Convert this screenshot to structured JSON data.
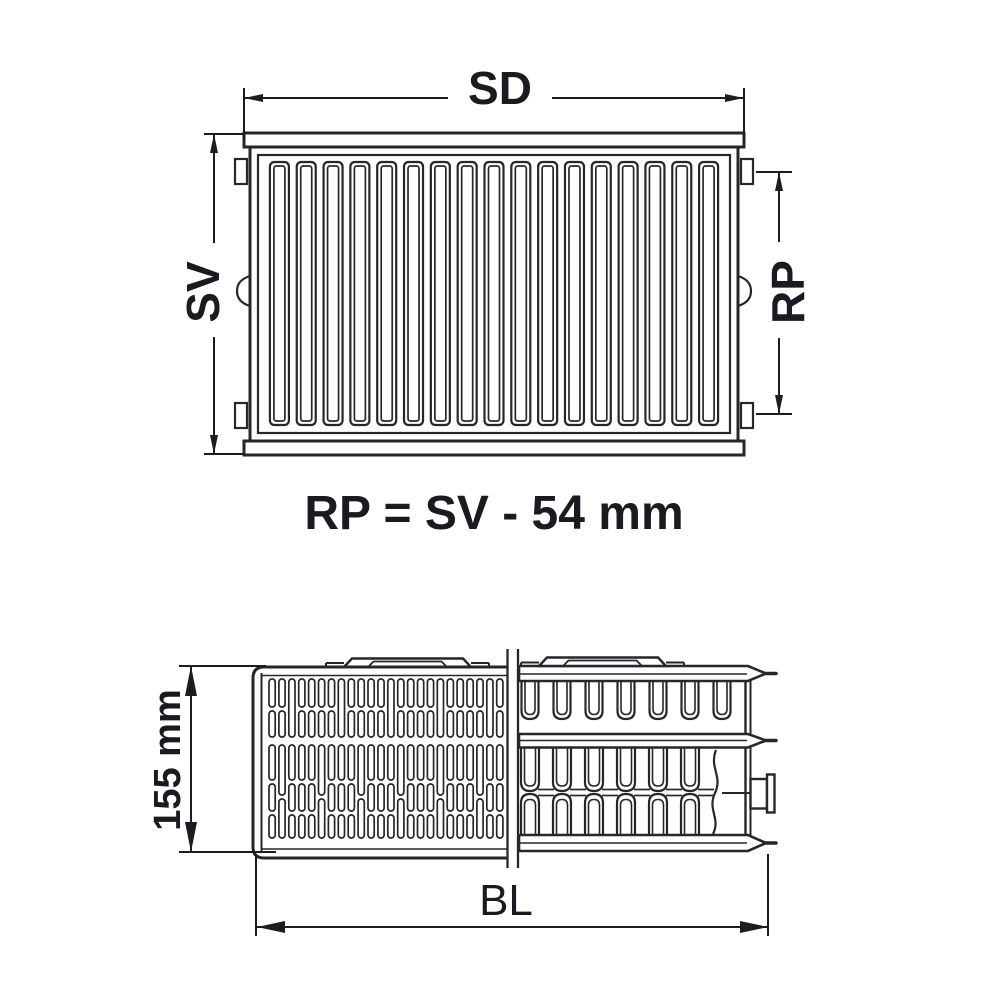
{
  "meta": {
    "title": "Panel radiator dimension drawing"
  },
  "labels": {
    "width_top": "SD",
    "height_left": "SV",
    "connection_right": "RP",
    "formula": "RP = SV - 54 mm",
    "depth_left": "155 mm",
    "length_bottom": "BL"
  },
  "colors": {
    "background": "#ffffff",
    "line": "#27272b",
    "dimension": "#1c1c22",
    "text": "#1a1a20"
  },
  "drawing": {
    "front_channel_count": 17,
    "grille_column_count": 24,
    "fin_row1_count": 7,
    "fin_row2_count": 6
  }
}
